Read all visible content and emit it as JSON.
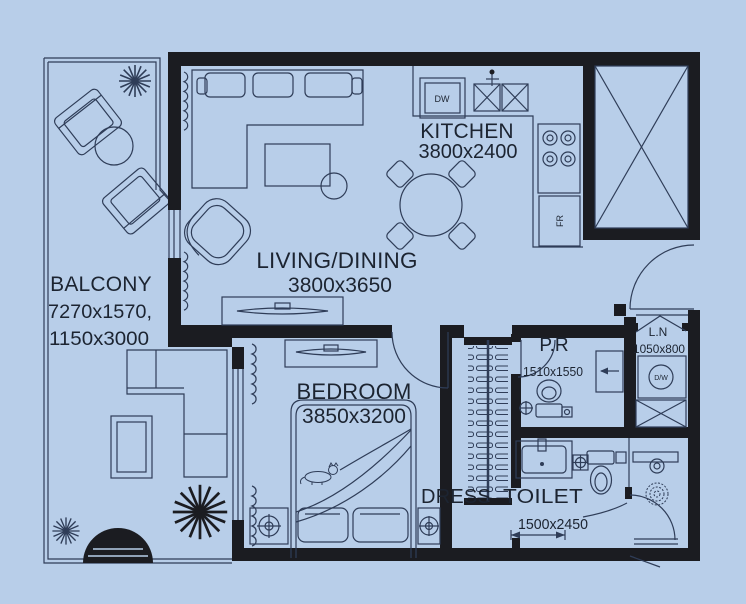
{
  "meta": {
    "title": "One-bedroom apartment floor plan"
  },
  "colors": {
    "background": "#b8cee9",
    "wall": "#1b1c21",
    "line": "#2f3d58",
    "text": "#1c2431"
  },
  "rooms": {
    "balcony": {
      "label": "BALCONY",
      "dims1": "7270x1570,",
      "dims2": "1150x3000"
    },
    "living_dining": {
      "label": "LIVING/DINING",
      "dims": "3800x3650"
    },
    "kitchen": {
      "label": "KITCHEN",
      "dims": "3800x2400"
    },
    "bedroom": {
      "label": "BEDROOM",
      "dims": "3850x3200"
    },
    "powder_room": {
      "label": "P.R",
      "dims": "1510x1550"
    },
    "linen": {
      "label": "L.N",
      "dims": "1050x800"
    },
    "dress": {
      "label": "DRESS"
    },
    "toilet": {
      "label": "TOILET",
      "dims": "1500x2450"
    }
  },
  "appliances": {
    "dishwasher": "DW",
    "fridge": "FR",
    "washer_dryer": "D/W"
  }
}
